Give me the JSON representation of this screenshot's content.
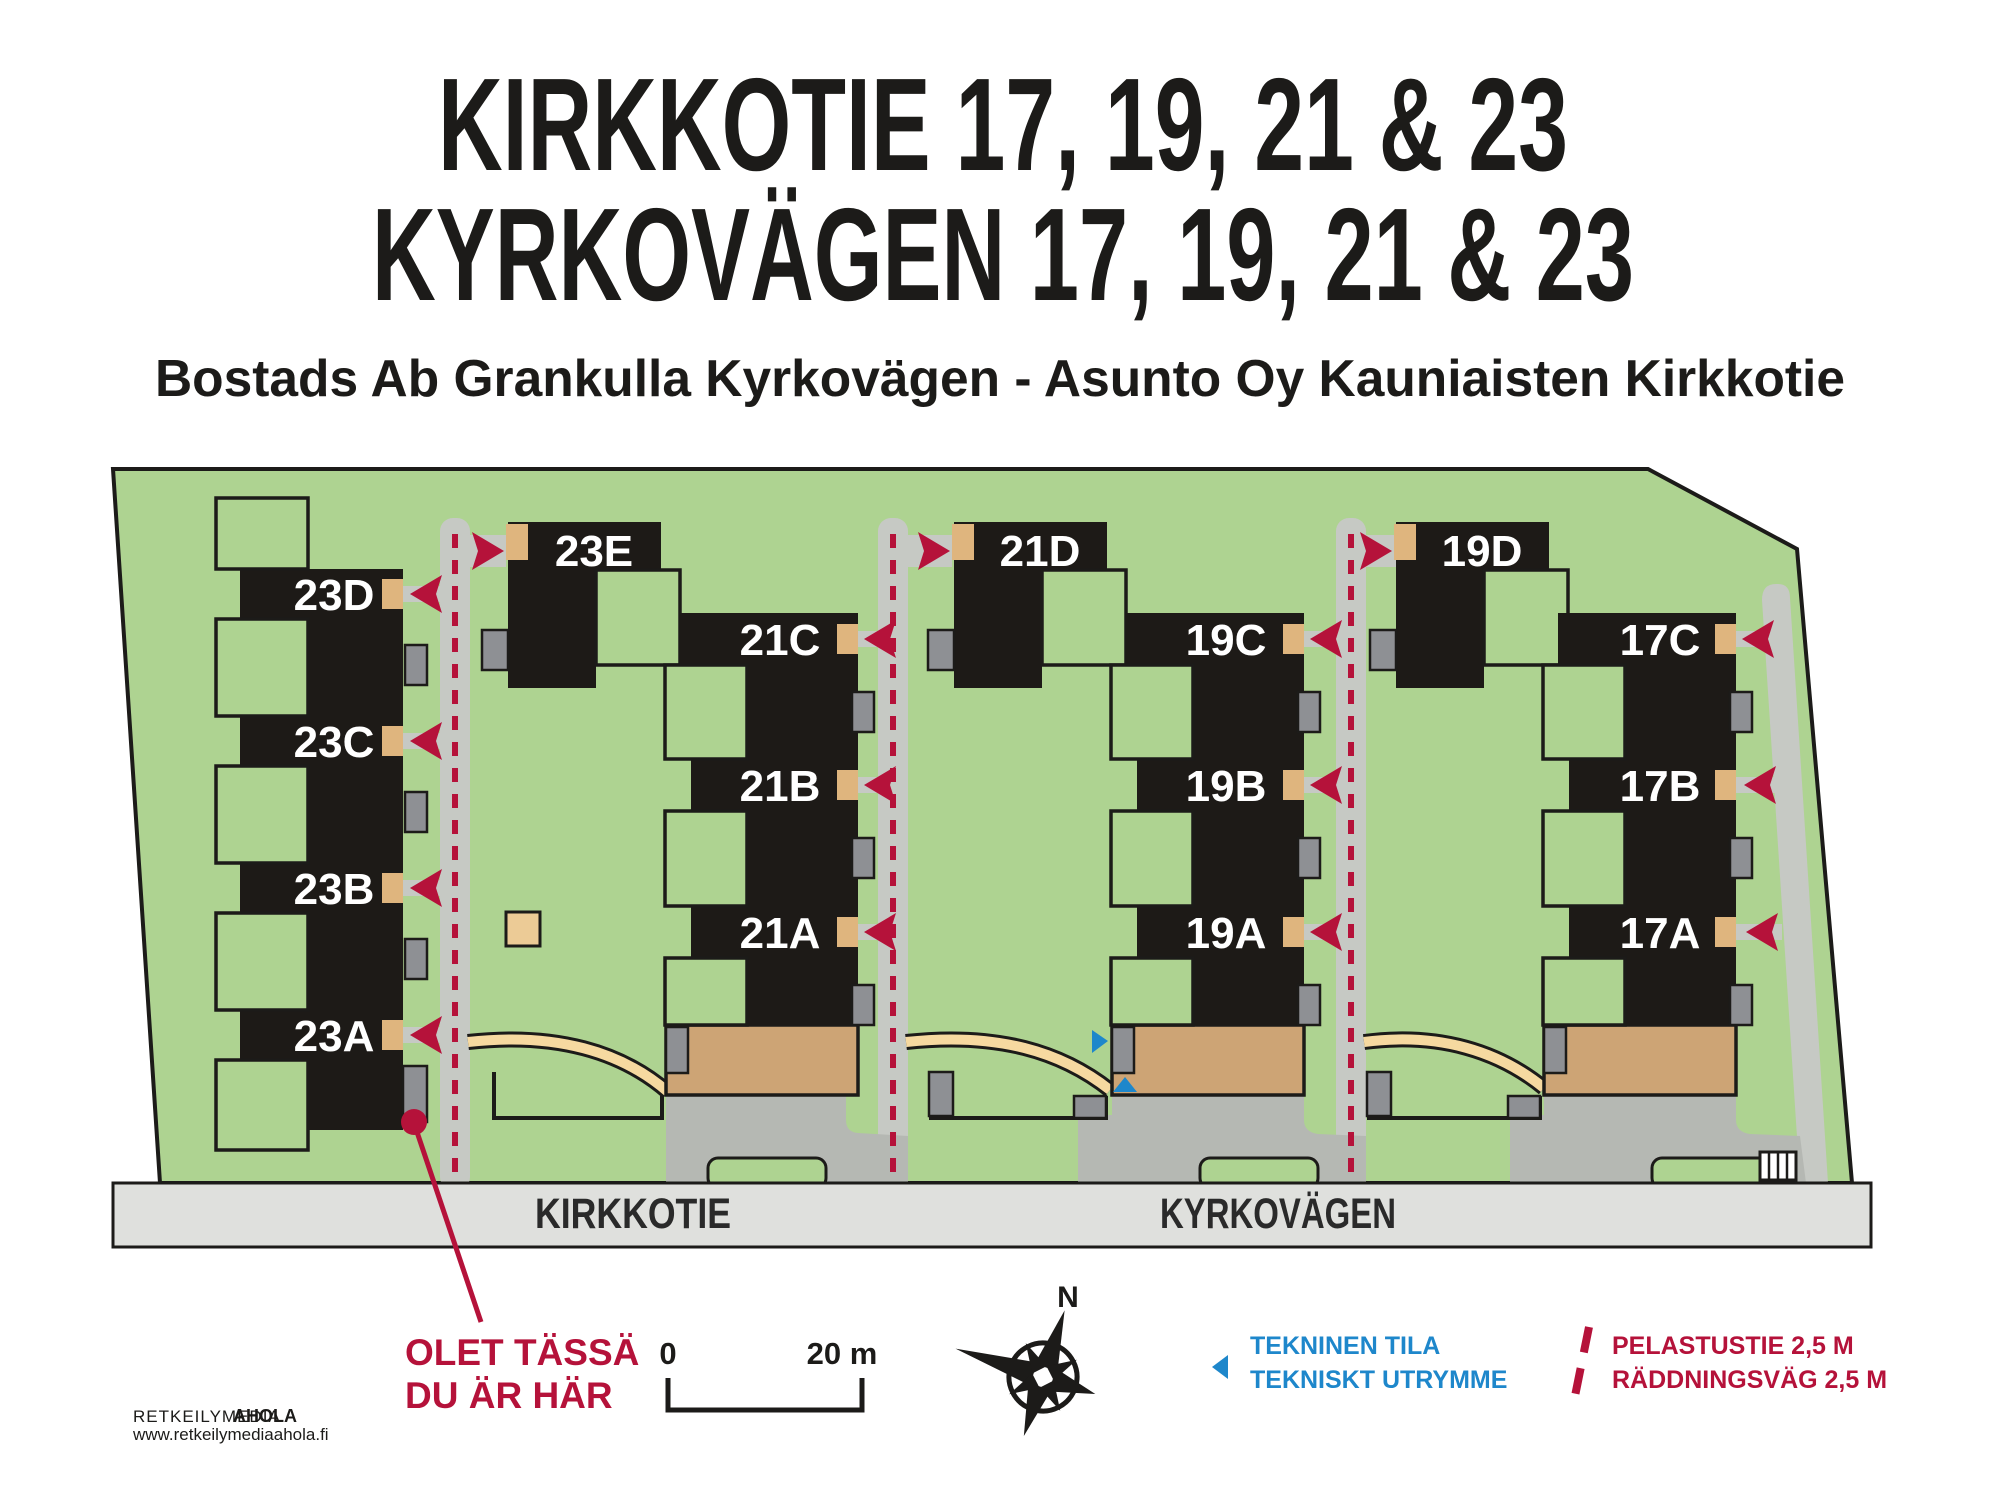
{
  "title": {
    "line1": "KIRKKOTIE 17, 19, 21 & 23",
    "line2": "KYRKOVÄGEN 17, 19, 21 & 23",
    "subtitle": "Bostads Ab Grankulla Kyrkovägen - Asunto Oy Kauniaisten Kirkkotie"
  },
  "units": {
    "23D": "23D",
    "23C": "23C",
    "23B": "23B",
    "23A": "23A",
    "23E": "23E",
    "21C": "21C",
    "21B": "21B",
    "21A": "21A",
    "21D": "21D",
    "19C": "19C",
    "19B": "19B",
    "19A": "19A",
    "19D": "19D",
    "17C": "17C",
    "17B": "17B",
    "17A": "17A"
  },
  "streets": {
    "kirkkotie": "KIRKKOTIE",
    "kyrkovagen": "KYRKOVÄGEN"
  },
  "you_are_here": {
    "line1": "OLET TÄSSÄ",
    "line2": "DU ÄR HÄR"
  },
  "scale_bar": {
    "start": "0",
    "end": "20 m"
  },
  "compass": {
    "north": "N"
  },
  "legend": {
    "technical": {
      "line1": "TEKNINEN TILA",
      "line2": "TEKNISKT UTRYMME"
    },
    "rescue": {
      "line1": "PELASTUSTIE 2,5 M",
      "line2": "RÄDDNINGSVÄG 2,5 M"
    }
  },
  "footer": {
    "brand": "RETKEILYMEDIA",
    "brand_bold": "AHOLA",
    "url": "www.retkeilymediaahola.fi"
  },
  "colors": {
    "site_green": "#aed391",
    "building_black": "#1d1a17",
    "road_gray": "#c6c9c4",
    "apron_gray": "#b5b8b3",
    "street_band_gray": "#dfe0dd",
    "entrance_tan": "#dfb57e",
    "parking_tan": "#cda475",
    "footpath_tan": "#f6d9a0",
    "technical_gray": "#8e9094",
    "rescue_red": "#b5123a",
    "technical_blue": "#1e87cb"
  }
}
